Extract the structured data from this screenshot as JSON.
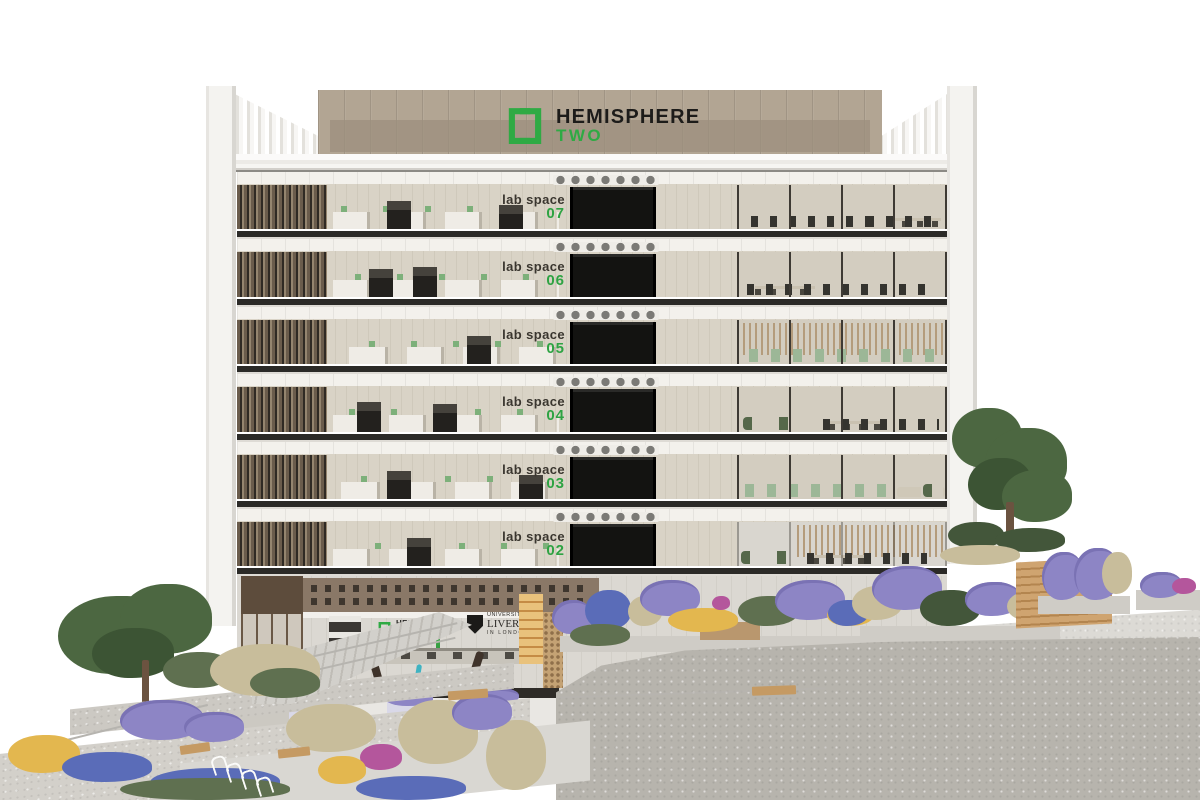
{
  "signage": {
    "line1": "HEMISPHERE",
    "line2": "TWO"
  },
  "floors": [
    {
      "name": "lab space",
      "number": "07"
    },
    {
      "name": "lab space",
      "number": "06"
    },
    {
      "name": "lab space",
      "number": "05"
    },
    {
      "name": "lab space",
      "number": "04"
    },
    {
      "name": "lab space",
      "number": "03"
    },
    {
      "name": "lab space",
      "number": "02"
    }
  ],
  "ground_floor": {
    "sign": {
      "line1": "HEMISPHERE",
      "line2": "TWO"
    },
    "crest": {
      "line1": "UNIVERSITY OF",
      "line2": "LIVERPOOL",
      "line3": "IN LONDON"
    }
  },
  "colors": {
    "brand_green": "#2faa44",
    "floor_number_green": "#2ea343",
    "label_text": "#3a362f",
    "signage_panel_tan": "#b2a593",
    "facade_white": "#f4f3f0",
    "interior_beige": "#d9d3c6",
    "slab_dark": "#2b2a27",
    "foreground_stone_gray": "#b7b4ad",
    "lavender": "#8d85c5",
    "foliage_green": "#4c6741"
  }
}
